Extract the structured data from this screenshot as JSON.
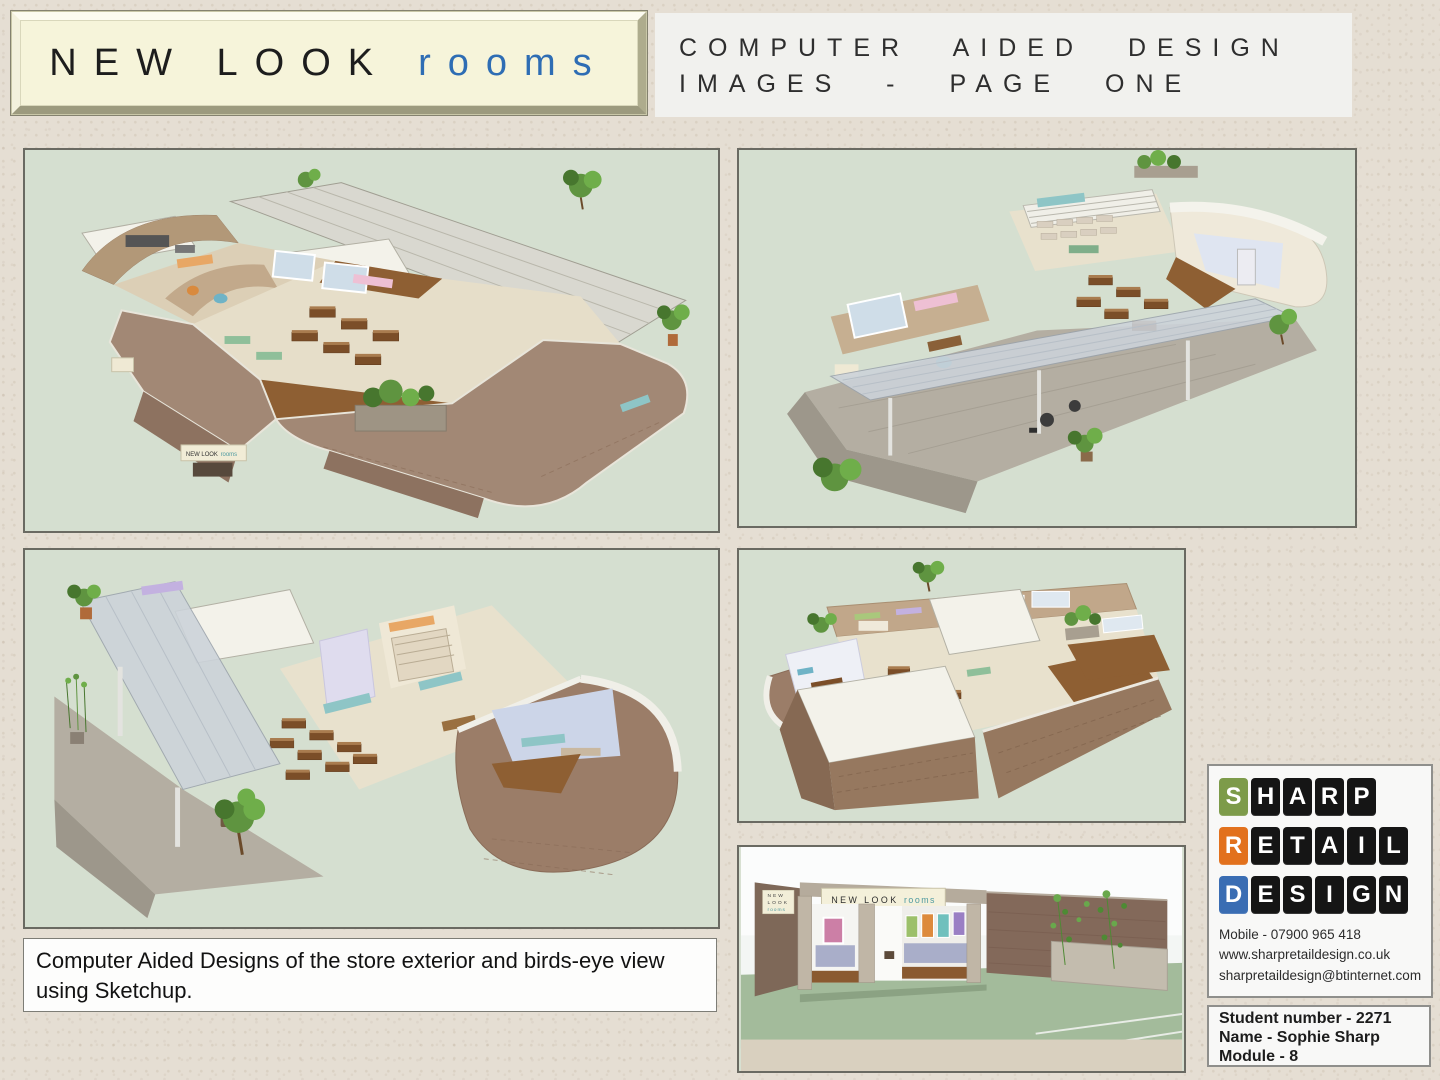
{
  "header": {
    "logo_primary": "NEW LOOK",
    "logo_secondary": "rooms",
    "logo_secondary_color": "#2e6db4",
    "title_line1": "COMPUTER AIDED DESIGN",
    "title_line2": "IMAGES - PAGE ONE"
  },
  "exterior_sign": {
    "primary": "NEW LOOK",
    "secondary": "rooms",
    "side_lines": [
      "NEW",
      "LOOK",
      "rooms"
    ]
  },
  "caption": "Computer Aided Designs of the store exterior and birds-eye view using Sketchup.",
  "branding": {
    "words": [
      {
        "text": "SHARP",
        "first_tile_color": "#7d9b4a"
      },
      {
        "text": "RETAIL",
        "first_tile_color": "#e2711d"
      },
      {
        "text": "DESIGN",
        "first_tile_color": "#3a6db3"
      }
    ],
    "tile_color": "#151515",
    "contact_lines": [
      "Mobile - 07900 965 418",
      "www.sharpretaildesign.co.uk",
      "sharpretaildesign@btinternet.com"
    ]
  },
  "student": {
    "lines": [
      "Student number - 2271",
      "Name - Sophie Sharp",
      "Module - 8"
    ]
  }
}
